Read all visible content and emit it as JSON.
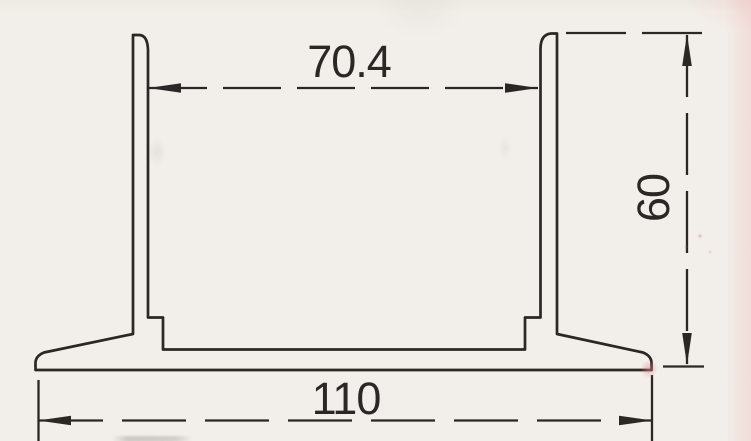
{
  "document": {
    "type": "technical-drawing",
    "description": "Scanned cross-section profile drawing of a channel-shaped extrusion with dimension annotations"
  },
  "dimensions": {
    "inner_width": {
      "value": "70.4",
      "orientation": "horizontal",
      "position": "top"
    },
    "height": {
      "value": "60",
      "orientation": "vertical",
      "position": "right"
    },
    "base_width": {
      "value": "110",
      "orientation": "horizontal",
      "position": "bottom"
    }
  },
  "colors": {
    "background": "#f2efea",
    "line": "#2b2724",
    "scan_tint": "#eeb4b2",
    "red_mark": "#e58e93"
  }
}
